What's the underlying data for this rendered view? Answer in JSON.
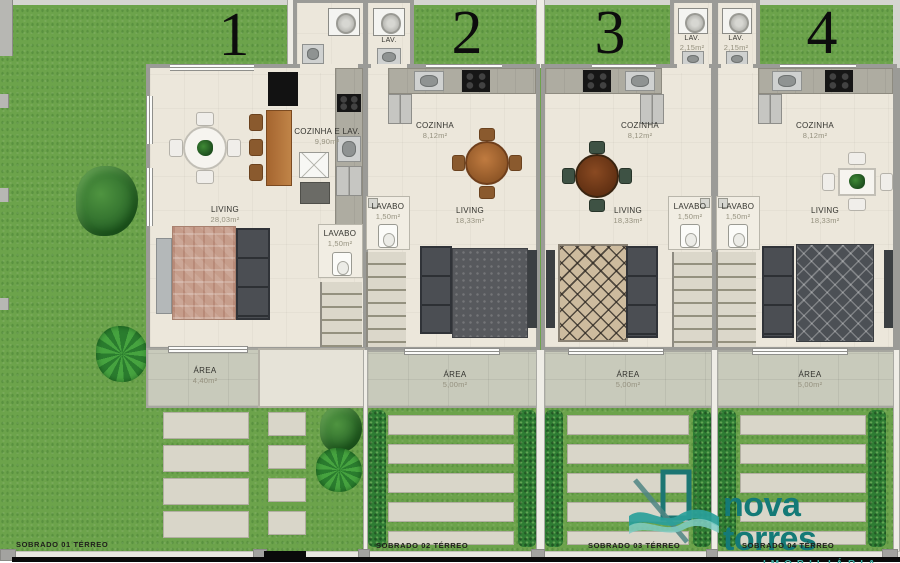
{
  "plan": {
    "units": [
      {
        "number": "1",
        "cozinha": "COZINHA E LAV.",
        "cozinha_m2": "9,90m²",
        "lavabo": "LAVABO",
        "lavabo_m2": "1,50m²",
        "living": "LIVING",
        "living_m2": "28,03m²",
        "area": "ÁREA",
        "area_m2": "4,40m²",
        "sobrado": "SOBRADO 01 TÉRREO"
      },
      {
        "number": "2",
        "lav": "LAV.",
        "cozinha": "COZINHA",
        "cozinha_m2": "8,12m²",
        "lavabo": "LAVABO",
        "lavabo_m2": "1,50m²",
        "living": "LIVING",
        "living_m2": "18,33m²",
        "area": "ÁREA",
        "area_m2": "5,00m²",
        "sobrado": "SOBRADO 02 TÉRREO"
      },
      {
        "number": "3",
        "lav": "LAV.",
        "lav_m2": "2,15m²",
        "cozinha": "COZINHA",
        "cozinha_m2": "8,12m²",
        "lavabo": "LAVABO",
        "lavabo_m2": "1,50m²",
        "living": "LIVING",
        "living_m2": "18,33m²",
        "area": "ÁREA",
        "area_m2": "5,00m²",
        "sobrado": "SOBRADO 03 TÉRREO"
      },
      {
        "number": "4",
        "lav": "LAV.",
        "lav_m2": "2,15m²",
        "cozinha": "COZINHA",
        "cozinha_m2": "8,12m²",
        "lavabo": "LAVABO",
        "lavabo_m2": "1,50m²",
        "living": "LIVING",
        "living_m2": "18,33m²",
        "area": "ÁREA",
        "area_m2": "5,00m²",
        "sobrado": "SOBRADO 04 TÉRREO"
      }
    ]
  },
  "logo": {
    "brand": "nova torres",
    "subtitle": "IMOBILIÁRIA"
  },
  "colors": {
    "grass": "#6ca34b",
    "hedge": "#2e7c33",
    "floor": "#ece7db",
    "porch": "#c8cabb",
    "wall": "#9b9b97",
    "logo_teal": "#147a77",
    "logo_wave": "#2aa09a",
    "logo_subtitle": "#45aca4"
  }
}
